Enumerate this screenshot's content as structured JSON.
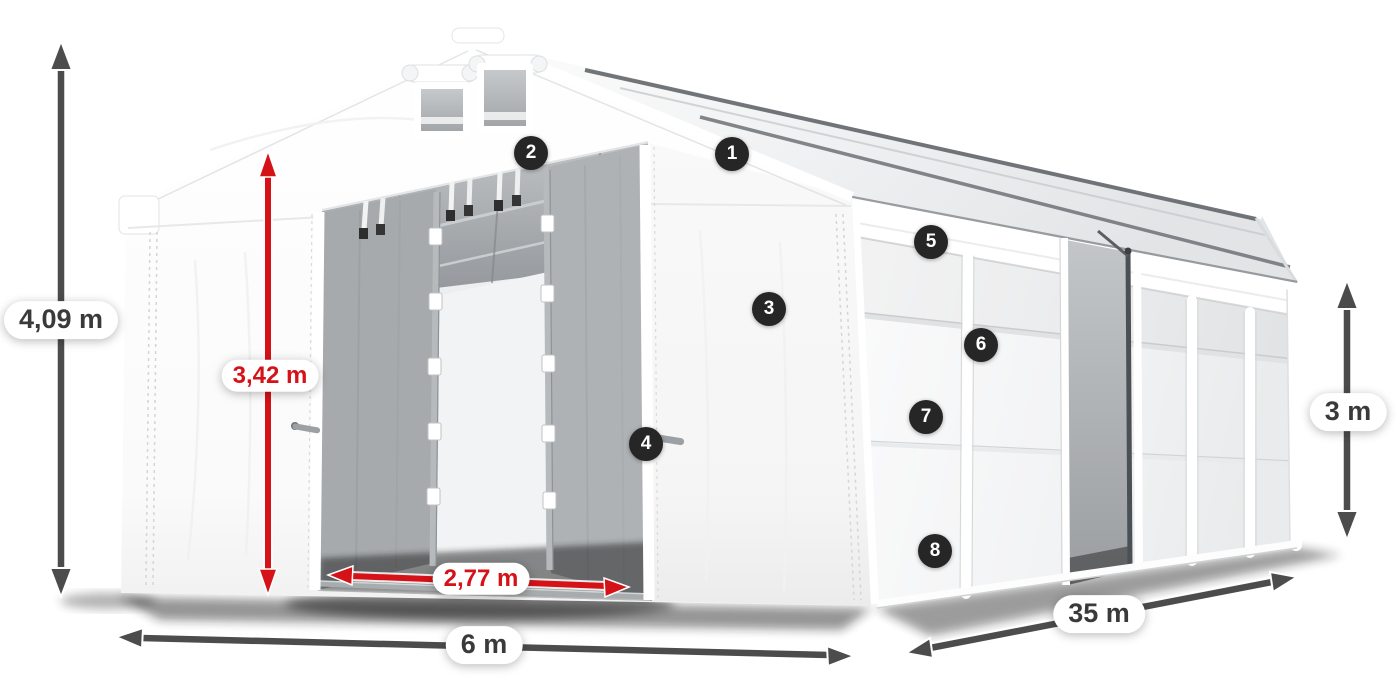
{
  "diagram": {
    "subject": "tent-dimension-diagram",
    "labels": {
      "total_height": "4,09 m",
      "inner_height": "3,42 m",
      "door_width": "2,77 m",
      "width": "6 m",
      "length": "35 m",
      "side_height": "3 m"
    },
    "badges": [
      "1",
      "2",
      "3",
      "4",
      "5",
      "6",
      "7",
      "8"
    ],
    "icons": {
      "dimension_arrow": "double-headed-measure-arrow",
      "callout": "numbered-circle-marker"
    },
    "colors": {
      "dimension_gray": "#4c4c4c",
      "dimension_red": "#d41217",
      "label_text": "#3a3a3a",
      "badge_bg": "#262626",
      "tent_white": "#ffffff",
      "interior_gray": "#a6aaad"
    }
  }
}
